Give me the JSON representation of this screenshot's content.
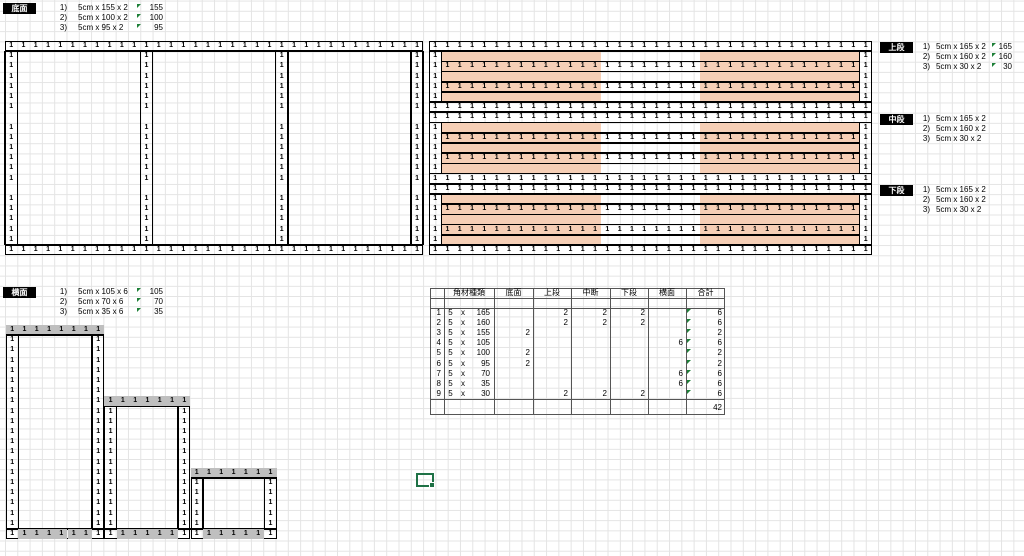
{
  "labels": {
    "bottom": "底面",
    "upper": "上段",
    "middle": "中段",
    "lower": "下段",
    "side": "横面"
  },
  "lists": {
    "bottom": {
      "items": [
        {
          "n": "1)",
          "t": "5cm x 155 x 2",
          "v": "155"
        },
        {
          "n": "2)",
          "t": "5cm x 100 x 2",
          "v": "100"
        },
        {
          "n": "3)",
          "t": "5cm x 95 x 2",
          "v": "95"
        }
      ]
    },
    "upper": {
      "items": [
        {
          "n": "1)",
          "t": "5cm x 165 x 2",
          "v": "165"
        },
        {
          "n": "2)",
          "t": "5cm x 160 x 2",
          "v": "160"
        },
        {
          "n": "3)",
          "t": "5cm x 30 x 2",
          "v": "30"
        }
      ]
    },
    "middle": {
      "items": [
        {
          "n": "1)",
          "t": "5cm x 165 x 2",
          "v": ""
        },
        {
          "n": "2)",
          "t": "5cm x 160 x 2",
          "v": ""
        },
        {
          "n": "3)",
          "t": "5cm x 30 x 2",
          "v": ""
        }
      ]
    },
    "lower": {
      "items": [
        {
          "n": "1)",
          "t": "5cm x 165 x 2",
          "v": ""
        },
        {
          "n": "2)",
          "t": "5cm x 160 x 2",
          "v": ""
        },
        {
          "n": "3)",
          "t": "5cm x 30 x 2",
          "v": ""
        }
      ]
    },
    "side": {
      "items": [
        {
          "n": "1)",
          "t": "5cm x 105 x 6",
          "v": "105"
        },
        {
          "n": "2)",
          "t": "5cm x 70 x 6",
          "v": "70"
        },
        {
          "n": "3)",
          "t": "5cm x 35 x 6",
          "v": "35"
        }
      ]
    }
  },
  "table": {
    "headers": [
      "角材種類",
      "底面",
      "上段",
      "中断",
      "下段",
      "横面",
      "合計"
    ],
    "rows": [
      [
        "1",
        "5",
        "x",
        "165",
        "",
        "2",
        "2",
        "2",
        "",
        "6"
      ],
      [
        "2",
        "5",
        "x",
        "160",
        "",
        "2",
        "2",
        "2",
        "",
        "6"
      ],
      [
        "3",
        "5",
        "x",
        "155",
        "2",
        "",
        "",
        "",
        "",
        "2"
      ],
      [
        "4",
        "5",
        "x",
        "105",
        "",
        "",
        "",
        "",
        "6",
        "6"
      ],
      [
        "5",
        "5",
        "x",
        "100",
        "2",
        "",
        "",
        "",
        "",
        "2"
      ],
      [
        "6",
        "5",
        "x",
        "95",
        "2",
        "",
        "",
        "",
        "",
        "2"
      ],
      [
        "7",
        "5",
        "x",
        "70",
        "",
        "",
        "",
        "",
        "6",
        "6"
      ],
      [
        "8",
        "5",
        "x",
        "35",
        "",
        "",
        "",
        "",
        "6",
        "6"
      ],
      [
        "9",
        "5",
        "x",
        "30",
        "",
        "2",
        "2",
        "2",
        "",
        "6"
      ]
    ],
    "total": "42"
  },
  "colors": {
    "pink": "#F6CFB6",
    "gray": "#BFBFBF",
    "green_triangle": "#1E8038",
    "selection_green": "#1E7145",
    "grid_line": "#E4E4E4",
    "border_black": "#000000"
  },
  "drawing": {
    "one": "1",
    "grid": {
      "cw": 12.3,
      "rh": 10.2
    },
    "bottom_face": {
      "x": 5,
      "y": 41,
      "cols": 34,
      "rows": 21,
      "vcols": [
        1,
        12,
        23,
        34
      ],
      "gap_rows": [
        8,
        15
      ]
    },
    "tiers": {
      "x": 429,
      "ys": [
        41,
        112.4,
        183.8
      ],
      "cols": 36,
      "rows": 7,
      "pink_segments_cols": [
        [
          2,
          14
        ],
        [
          23,
          35
        ]
      ],
      "one_rows": [
        1,
        3,
        5,
        7
      ]
    },
    "staircase": {
      "x": 6,
      "y": 325,
      "rows": 21,
      "steps": [
        {
          "c0": 1,
          "c1": 8,
          "r0": 1
        },
        {
          "c0": 9,
          "c1": 15,
          "r0": 8
        },
        {
          "c0": 16,
          "c1": 22,
          "r0": 15
        }
      ]
    },
    "table_layout": {
      "x": 430,
      "y": 288,
      "col_edges": [
        0,
        14,
        64,
        103,
        141,
        180,
        218,
        256,
        295
      ],
      "header_h": 9.5,
      "data_top": 20,
      "row_h": 10.1,
      "line_after_rows": 111,
      "height": 125.5
    }
  }
}
